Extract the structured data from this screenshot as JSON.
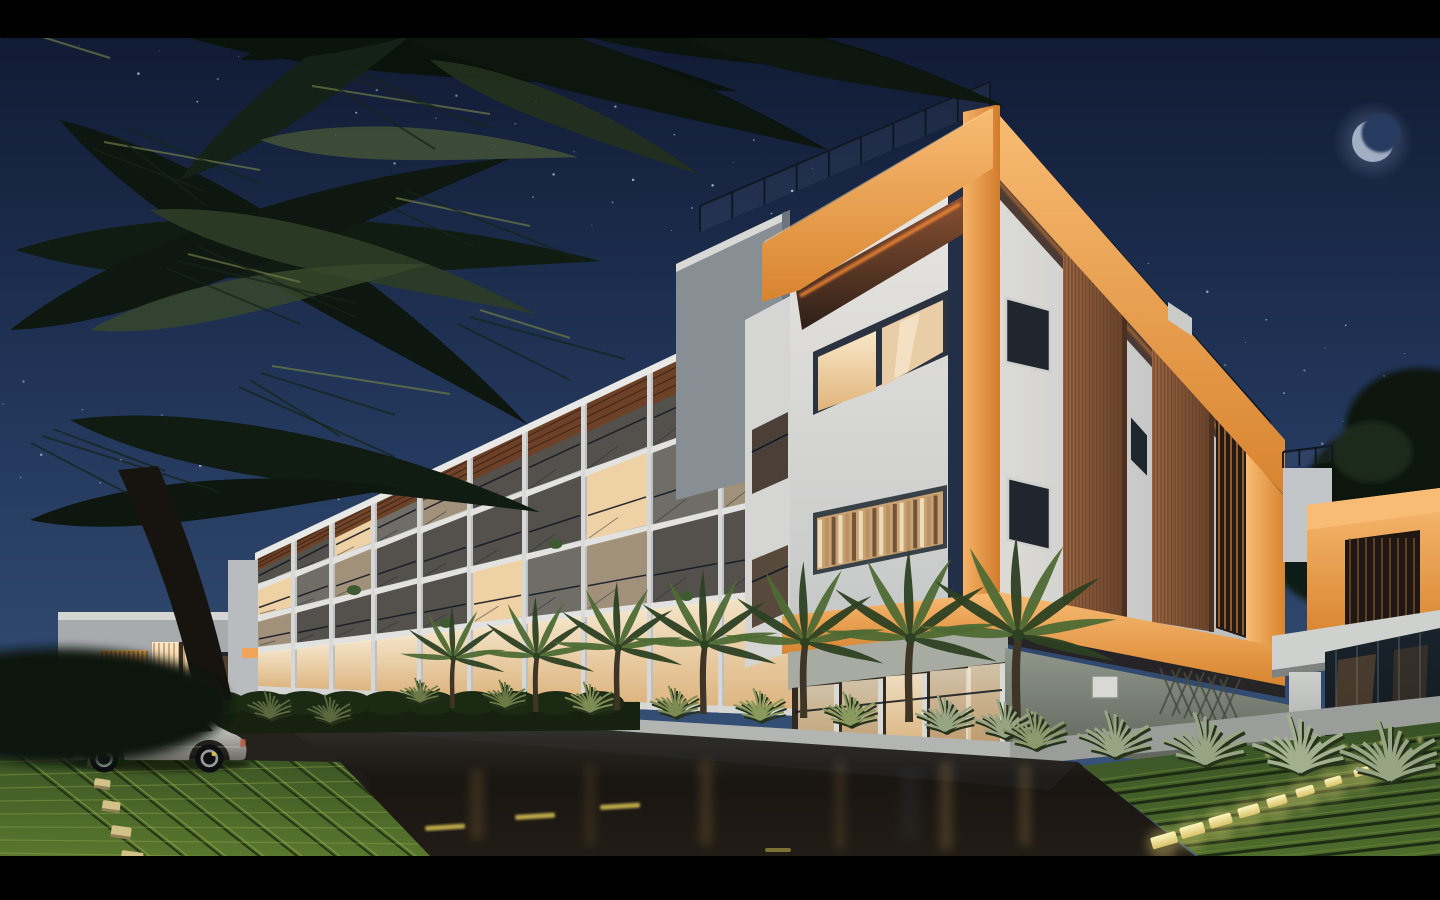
{
  "scene": {
    "caption": "Night-time 3D architectural rendering of a modern apartment complex with orange accent frames, lit balconies, palm trees, a wet street and a parked silver SUV under a starry sky with a crescent moon",
    "type": "3d-architectural-render",
    "time_of_day": "night"
  },
  "sky": {
    "stars": true,
    "moon_phase": "crescent"
  },
  "building": {
    "name": "apartment-complex",
    "floors_visible": 4,
    "accent_color_name": "orange",
    "features": [
      "balconies",
      "glass-railings",
      "wood-louvers",
      "pergola-slats",
      "rooftop-glass-railing",
      "lit-interiors"
    ]
  },
  "vehicle": {
    "type": "suv",
    "color_name": "silver",
    "facing": "left"
  },
  "street": {
    "surface": "wet-asphalt",
    "markings": "yellow-dashes",
    "curb_lights": true
  },
  "landscape": {
    "palms_foreground": true,
    "palms_street": 7,
    "grass_pavers": true,
    "ornamental_grasses": true,
    "hedges": true
  },
  "colors": {
    "letterbox": "#000000",
    "sky-top": "#0f1830",
    "sky-mid": "#22365a",
    "sky-horizon": "#3e5a82",
    "star": "#d2dcee",
    "moon": "#a9b4c8",
    "moon-glow": "#7e93b4",
    "moon-carve": "#263a5e",
    "accent-orange": "#f0a558",
    "accent-orange-light": "#f8bc74",
    "accent-orange-deep": "#d8842f",
    "underglow-orange": "#ff8d35",
    "soffit-brown": "#3a2820",
    "wall-white": "#e3e2de",
    "wall-light": "#cfd1d1",
    "wall-shade": "#b2b6bb",
    "wall-grey": "#8a9197",
    "reveal-navy": "#232e47",
    "window-warm": "#f2d6ac",
    "window-bright": "#f9e8ca",
    "window-dark": "#20262e",
    "wood": "#9a6540",
    "wood-dark": "#64402a",
    "pergola": "#6e4126",
    "road": "#1d1915",
    "lane-yellow": "#d9c355",
    "sidewalk": "#b2b5b2",
    "walkway": "#9a9d9a",
    "ground-wall": "#7d8577",
    "grass-dark": "#2c421e",
    "grass-light": "#55732c",
    "grass-line": "#a4b153",
    "curb-stone": "#d2c288",
    "curb-glow": "#f6e9a2",
    "foliage-dark": "#0b130d",
    "foliage-mid": "#1c2a16",
    "foliage-light": "#5d7a3c",
    "tuft-green": "#97a584",
    "car-silver": "#cfcfca",
    "car-glass": "#161b21",
    "interior-warm": "#e0a057"
  }
}
